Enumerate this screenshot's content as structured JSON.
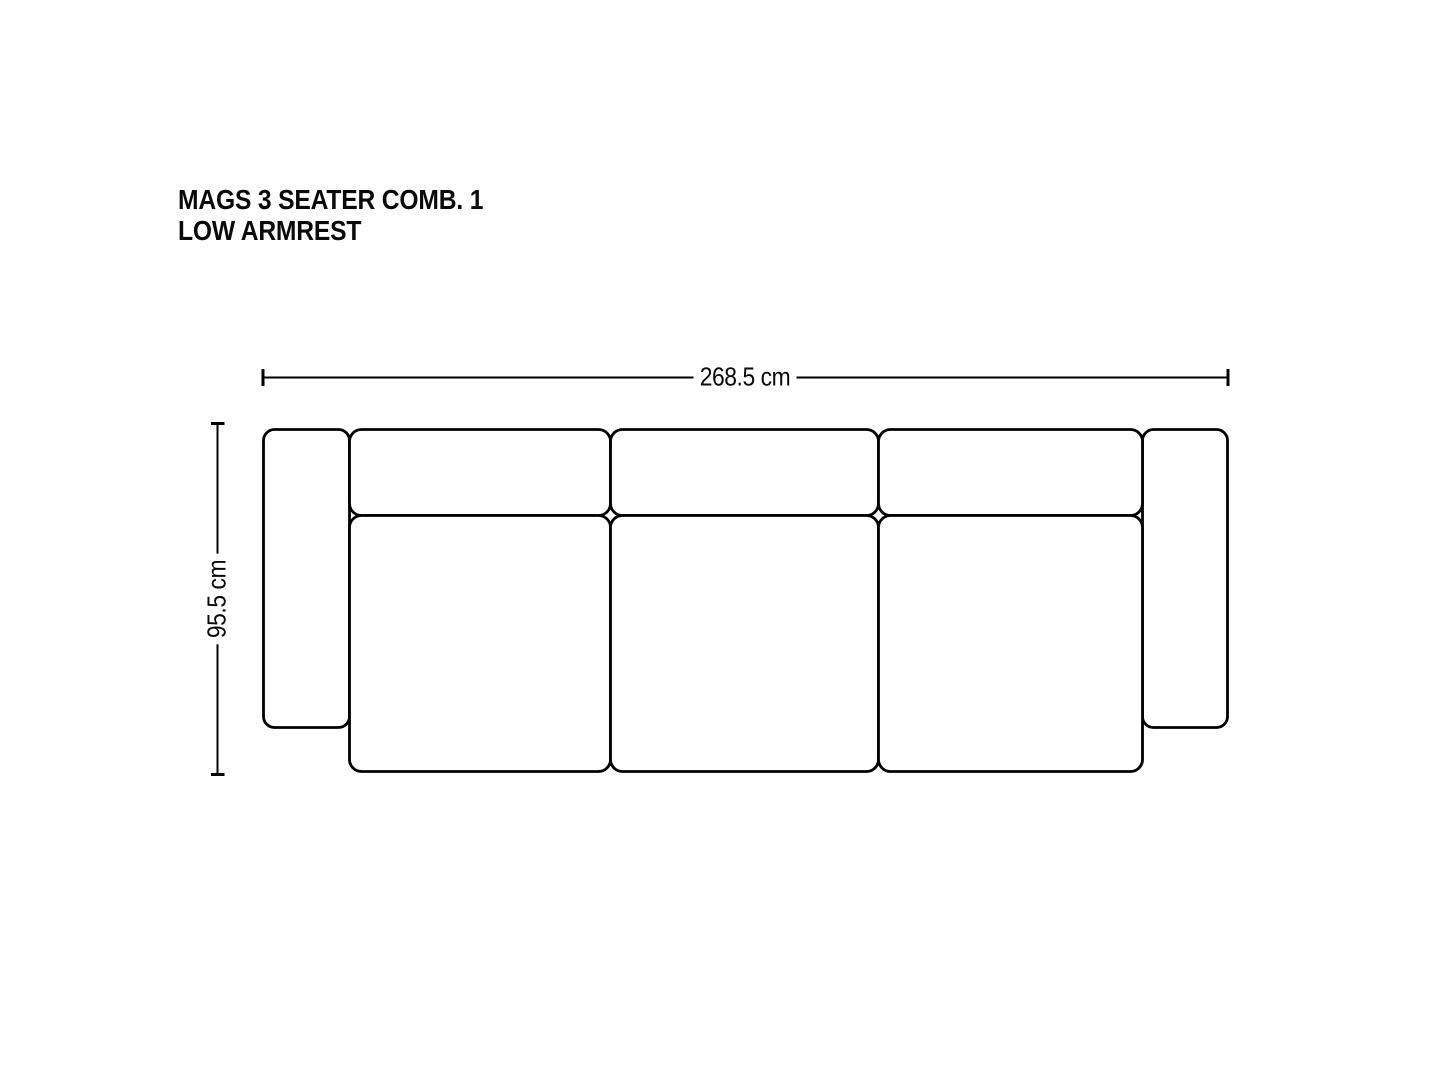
{
  "colors": {
    "line": "#000000",
    "text": "#0a0a0a",
    "background": "#ffffff"
  },
  "title": {
    "line1": "MAGS 3 SEATER COMB. 1",
    "line2": "LOW ARMREST"
  },
  "dimensions": {
    "width": {
      "label": "268.5 cm"
    },
    "depth": {
      "label": "95.5 cm"
    }
  },
  "diagram": {
    "parts": [
      "left-armrest",
      "backrest-cushion-1",
      "backrest-cushion-2",
      "backrest-cushion-3",
      "seat-cushion-1",
      "seat-cushion-2",
      "seat-cushion-3",
      "right-armrest"
    ]
  }
}
